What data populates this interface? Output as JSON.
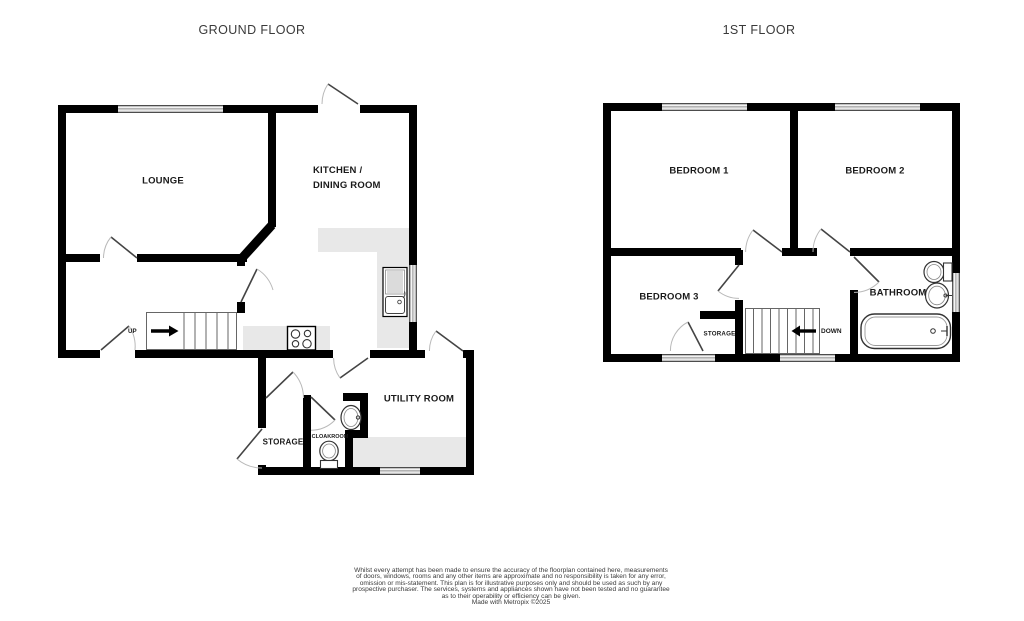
{
  "titles": {
    "ground": "GROUND FLOOR",
    "first": "1ST FLOOR"
  },
  "ground_floor": {
    "rooms": {
      "lounge": "LOUNGE",
      "kitchen_line1": "KITCHEN /",
      "kitchen_line2": "DINING ROOM",
      "utility": "UTILITY ROOM",
      "storage": "STORAGE",
      "cloakroom": "CLOAKROOM"
    },
    "stairs_direction": "UP",
    "fixtures": [
      "staircase-up",
      "hob",
      "kitchen-sink-unit",
      "wash-basin",
      "toilet"
    ]
  },
  "first_floor": {
    "rooms": {
      "bedroom1": "BEDROOM 1",
      "bedroom2": "BEDROOM 2",
      "bedroom3": "BEDROOM 3",
      "bathroom": "BATHROOM",
      "storage": "STORAGE"
    },
    "stairs_direction": "DOWN",
    "fixtures": [
      "staircase-down",
      "toilet",
      "wash-basin",
      "bathtub"
    ]
  },
  "footer": {
    "lines": [
      "Whilst every attempt has been made to ensure the accuracy of the floorplan contained here, measurements",
      "of doors, windows, rooms and any other items are approximate and no responsibility is taken for any error,",
      "omission or mis-statement. This plan is for illustrative purposes only and should be used as such by any",
      "prospective purchaser. The services, systems and appliances shown have not been tested and no guarantee",
      "as to their operability or efficiency can be given.",
      "Made with Metropix ©2025"
    ]
  },
  "colors": {
    "wall": "#000000",
    "counter": "#e8e8e8",
    "label_text": "#1a1a1a",
    "background": "#ffffff"
  }
}
